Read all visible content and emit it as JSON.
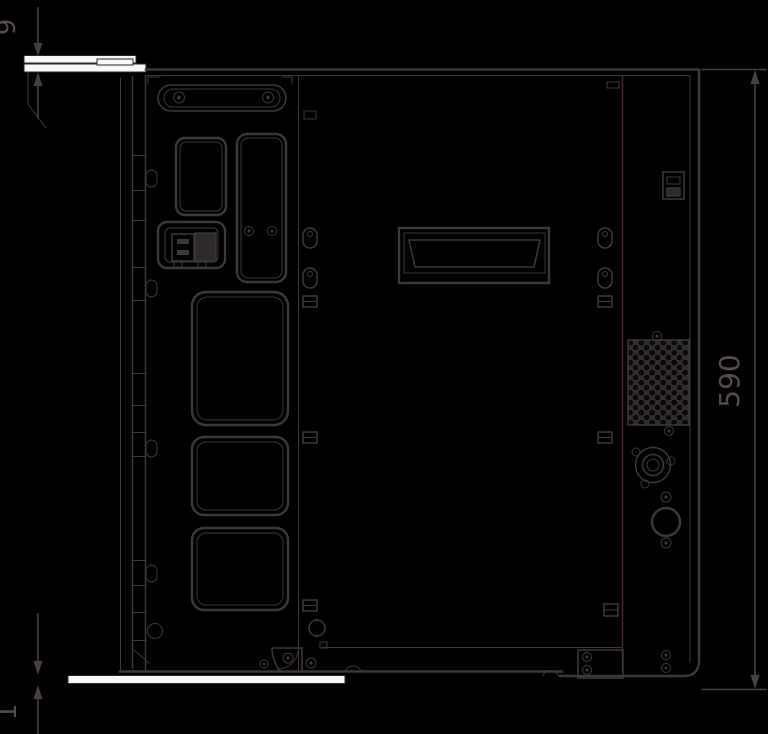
{
  "drawing": {
    "kind": "technical-side-view-drawing",
    "colors": {
      "background": "#000000",
      "line": "#3e373b",
      "seam_accent": "#41232a",
      "plate_fill": "#f8f8f8",
      "dimension_text": "#564b51"
    },
    "dimensions": {
      "top_plate": {
        "value": "9",
        "orientation": "vertical-rotated"
      },
      "body_height": {
        "value": "590",
        "orientation": "vertical-rotated"
      },
      "bottom_plate": {
        "value": "1",
        "orientation": "vertical-rotated"
      }
    }
  }
}
